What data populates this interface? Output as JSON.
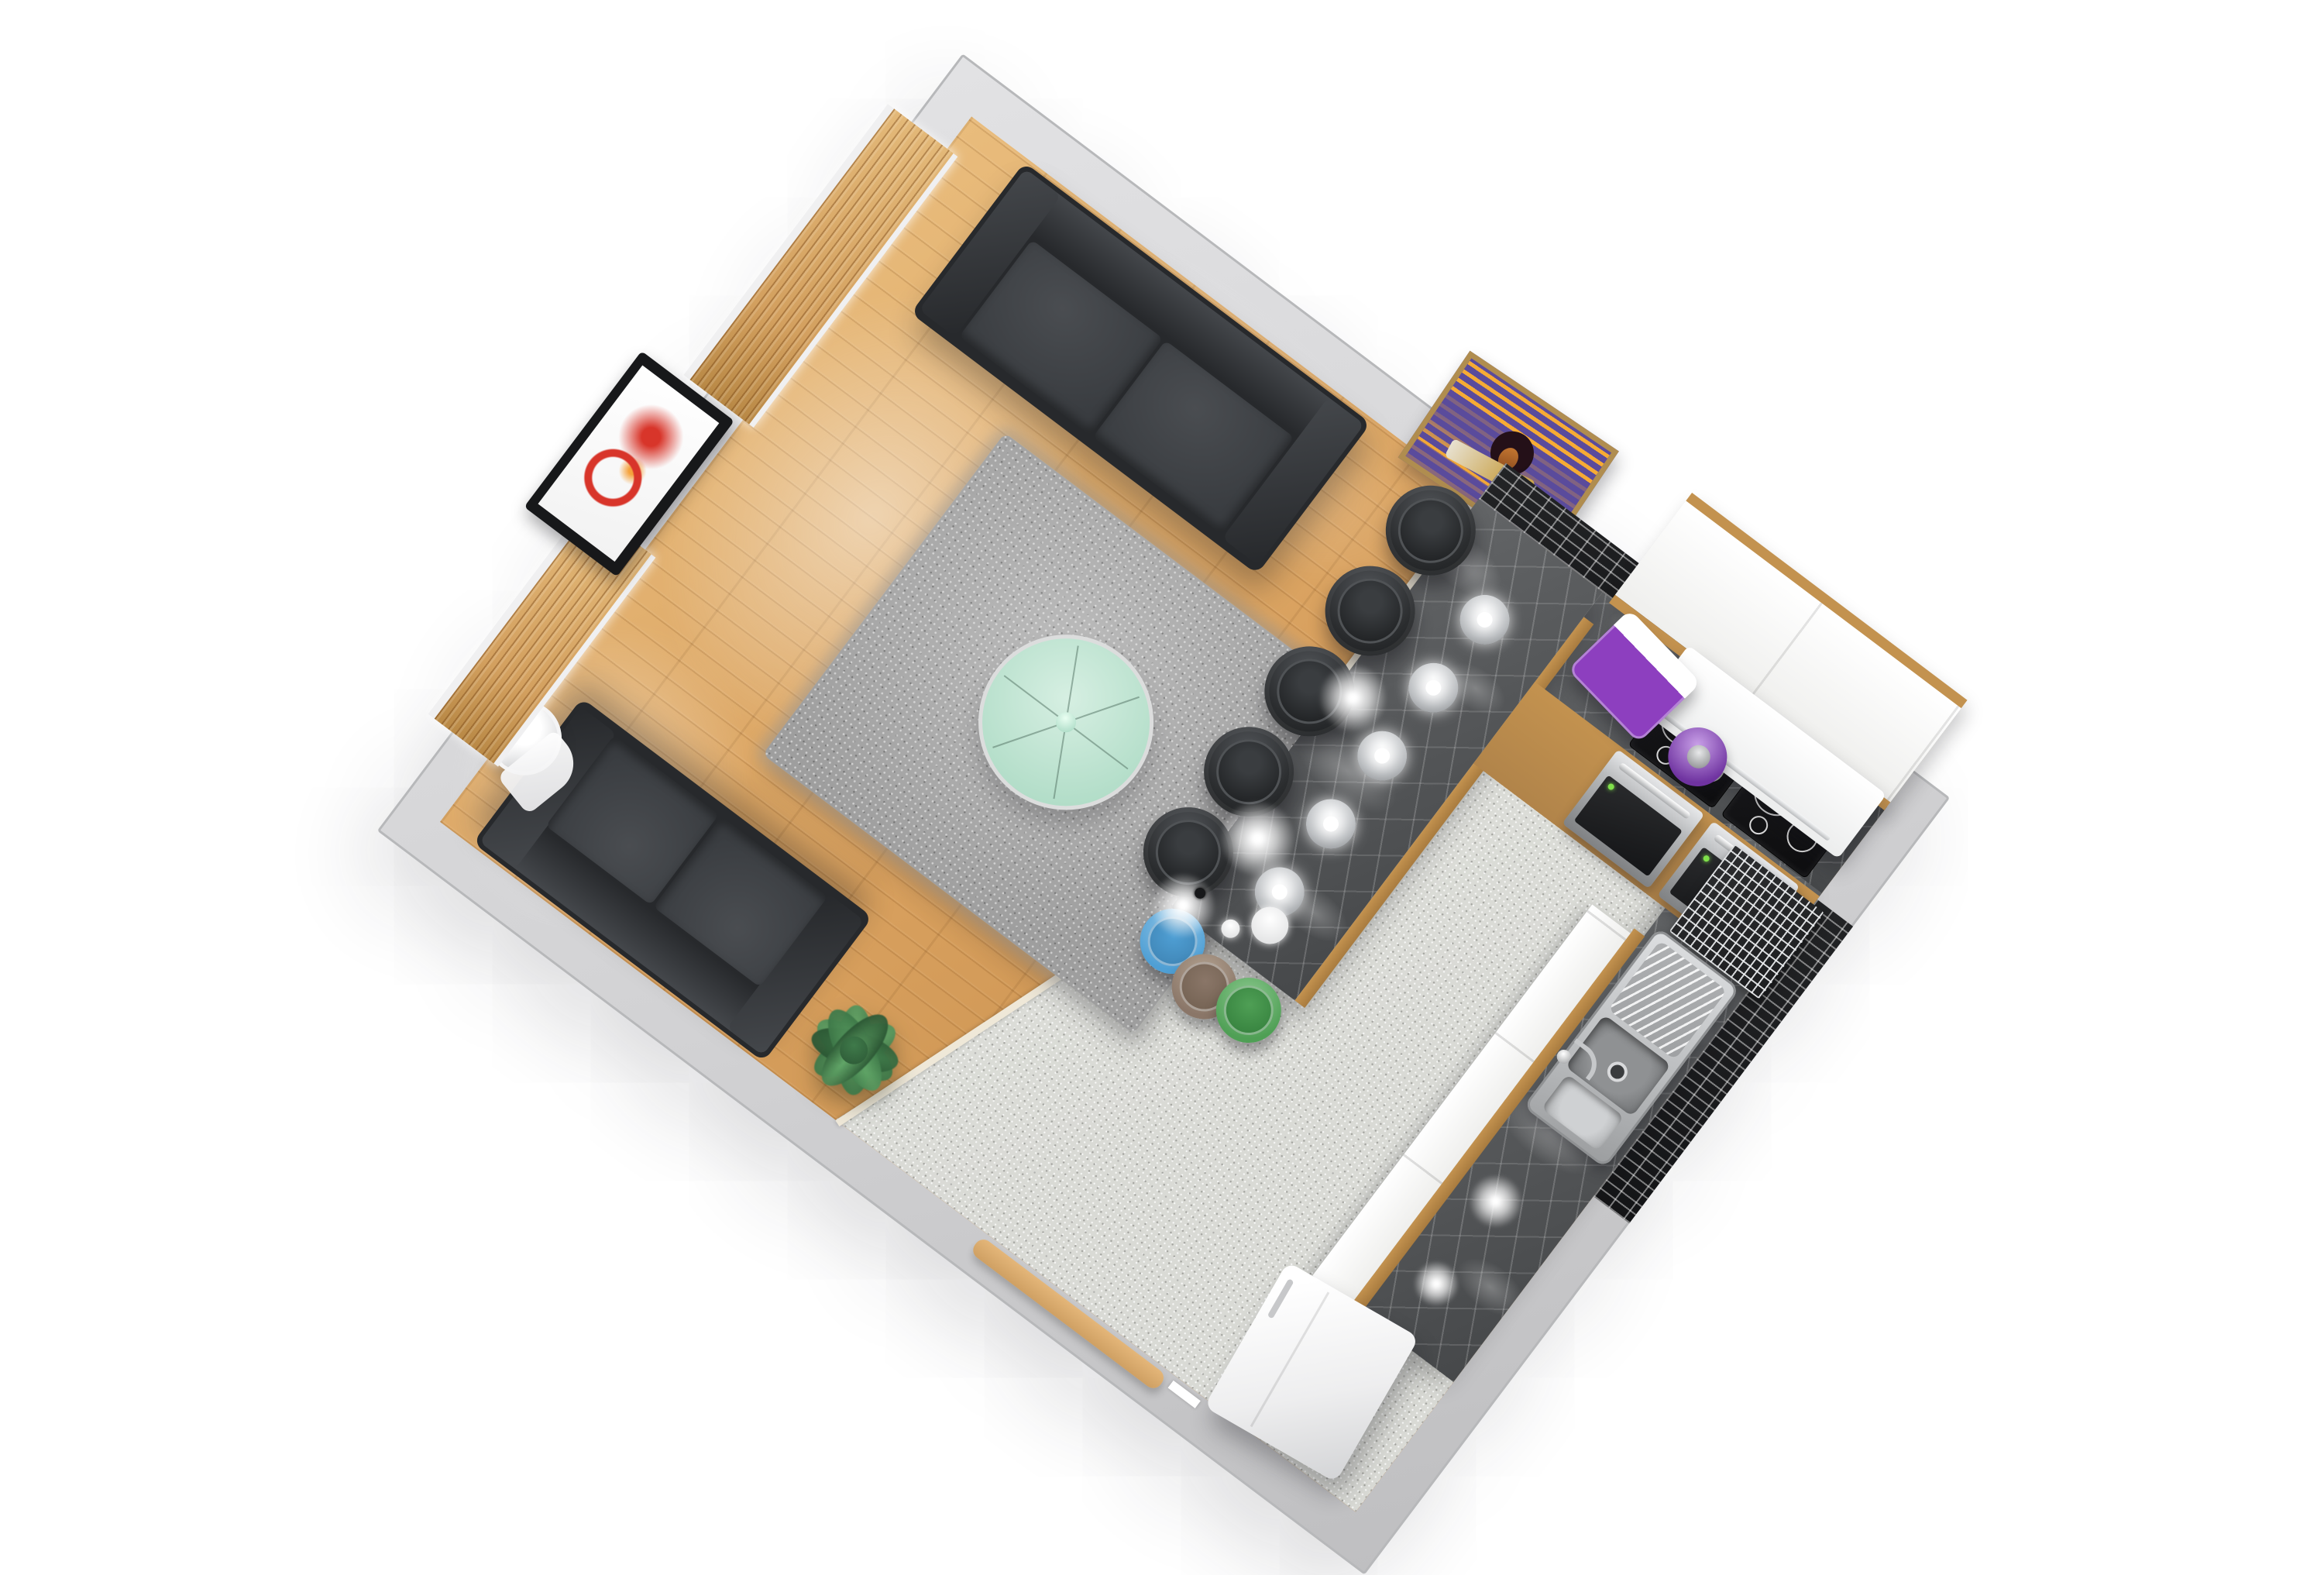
{
  "scene": {
    "title": "3D floor plan render — open-plan living room and kitchen, top-down dollhouse view",
    "view": "top-down 3D render, room rotated ~37° on white background",
    "rotation_deg": 37,
    "areas": {
      "living": "Wood parquet floor living area",
      "kitchen": "Speckled terrazzo floor kitchen area"
    }
  },
  "colors": {
    "page": "#ffffff",
    "wall": "#d2d2d4",
    "wallHi": "#e2e2e4",
    "wallLo": "#bfbfc1",
    "wallEdge": "#b7b8ba",
    "trim": "#ececee",
    "wood": "#d8a05e",
    "woodHi": "#e9bc7c",
    "woodLo": "#c08744",
    "tile": "#d9dad5",
    "tileHi": "#e6e7e2",
    "strip": "#efe8d8",
    "rug": "#9e9e9e",
    "rugHi": "#bcbcbc",
    "glass": "#b2ddc8",
    "glassHi": "#d6efe2",
    "glassRim": "#dcdddd",
    "glassHub": "#9fd4bd",
    "sofa": "#3a3d41",
    "sofaCu": "#4a4d51",
    "sofaBk": "#44474b",
    "sofaDk": "#27292c",
    "plant": "#3f7a4a",
    "plantHi": "#63a86a",
    "plantLo": "#2b5634",
    "blind": "#d3a05f",
    "blindHi": "#e3b878",
    "blindLo": "#b98946",
    "frame": "#f0f0f1",
    "tvArt": "#d8352a",
    "tvGlow": "#f5a23c",
    "poster": "#5a4b9c",
    "posterFr": "#b08d4f",
    "posterSkin": "#c87a32",
    "marbleA": "#636567",
    "marbleB": "#46484a",
    "woodTrim": "#c3924f",
    "cabWhite": "#efefed",
    "hood": "#eceded",
    "cook": "#0e0e10",
    "steel": "#b9bbbd",
    "ovenGl": "#1d1e20",
    "led": "#7fe04a",
    "purple": "#8d3fbf",
    "purpleDk": "#6f33a0",
    "tileBk": "#131416",
    "chrome": "rgba(236,238,240,0.9)",
    "chrome2": "#c6c8ca",
    "bowl": "#8f9193",
    "fridge": "#eeeeef",
    "binGray": "#d6d7d9",
    "stool": "#2b2d2f",
    "stoolHi": "#515458",
    "stoolSeat": "#232527",
    "mBlue": "#4f9fd4",
    "mTaupe": "#8a7668",
    "mGreen": "#4f9f55",
    "pend": "#b9bcbf",
    "doorWood": "#e4b679"
  },
  "objects": {
    "room": {
      "label": "Open-plan studio room, gray walls"
    },
    "living_floor": {
      "label": "Wood parquet floor"
    },
    "kitchen_floor": {
      "label": "Terrazzo kitchen floor"
    },
    "rug": {
      "label": "Gray shag rug"
    },
    "coffee_table": {
      "label": "Round green glass coffee table"
    },
    "sofa_top": {
      "label": "Dark gray three-seat sofa against top wall"
    },
    "sofa_bottom": {
      "label": "Dark gray two-seat sofa against bottom wall"
    },
    "plant": {
      "label": "Green potted plant"
    },
    "bin": {
      "label": "White cylindrical bin"
    },
    "window_upper": {
      "label": "Large window with wooden blinds"
    },
    "window_lower": {
      "label": "Small window with wooden blinds"
    },
    "tv": {
      "label": "Wall-mounted TV with red artwork on screen"
    },
    "poster": {
      "label": "Framed purple funk-band poster on top wall"
    },
    "island": {
      "label": "Kitchen island bar with dark marble top"
    },
    "bar_stool": {
      "label": "Black round bar stool",
      "count": 5
    },
    "mini_stools": {
      "labels": [
        "Blue stool",
        "Taupe stool",
        "Green stool"
      ]
    },
    "pendant": {
      "label": "Chrome pendant lamp over island",
      "count": 5
    },
    "ceiling_disc": {
      "label": "Ceiling light disc",
      "count": 2
    },
    "breadbox": {
      "label": "Purple bread box"
    },
    "kettle": {
      "label": "Purple kettle"
    },
    "backsplash": {
      "label": "Black mosaic tile backsplash"
    },
    "upper_cabinets": {
      "label": "White upper cabinets with wood trim"
    },
    "hood": {
      "label": "White extractor hood"
    },
    "cooktop": {
      "label": "Black ceramic cooktop",
      "count": 2
    },
    "oven": {
      "label": "Built-in stainless oven",
      "count": 2
    },
    "counter_top_wall": {
      "label": "Dark marble counter along top wall"
    },
    "counter_right_wall": {
      "label": "Dark marble counter along right wall"
    },
    "dish_rack": {
      "label": "Chrome dish rack in corner"
    },
    "sink": {
      "label": "Stainless sink with drainer and faucet"
    },
    "cabinet_fronts": {
      "label": "White base-cabinet fronts"
    },
    "fridge": {
      "label": "White refrigerator"
    },
    "door": {
      "label": "Open wooden entry door at bottom wall"
    },
    "island_knob": {
      "label": "Small black object on island"
    }
  }
}
